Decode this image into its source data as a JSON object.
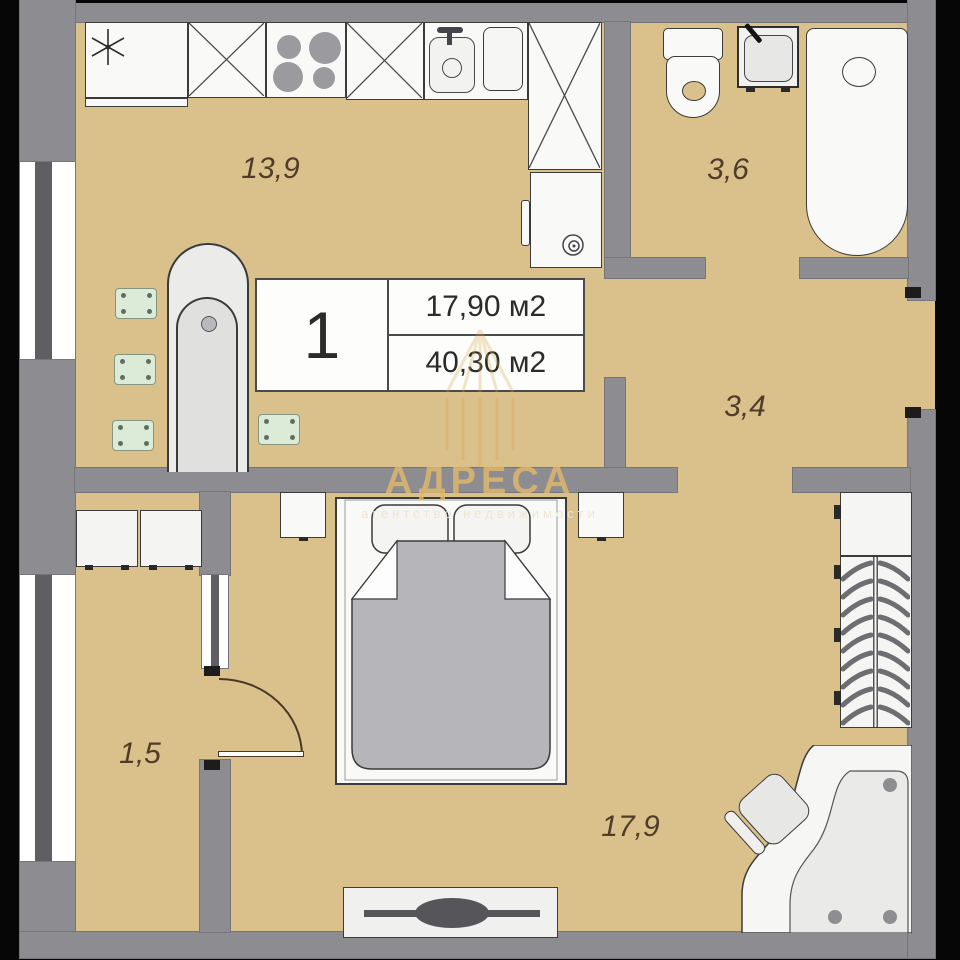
{
  "info_box": {
    "number": "1",
    "living_area": "17,90 м2",
    "total_area": "40,30 м2"
  },
  "rooms": {
    "kitchen_living": "13,9",
    "bathroom": "3,6",
    "hall": "3,4",
    "balcony": "1,5",
    "bedroom": "17,9"
  },
  "watermark": {
    "title": "АДРЕСА",
    "subtitle": "агентство недвижимости"
  },
  "colors": {
    "floor": "#dac08b",
    "wall": "#8d8d91",
    "outline": "#3b3b3b",
    "furniture": "#f9f9f7",
    "stool_green": "#dcead8",
    "blanket_gray": "#b6b6ba",
    "watermark_gold": "#e3b96b",
    "label_brown": "#503c28"
  }
}
